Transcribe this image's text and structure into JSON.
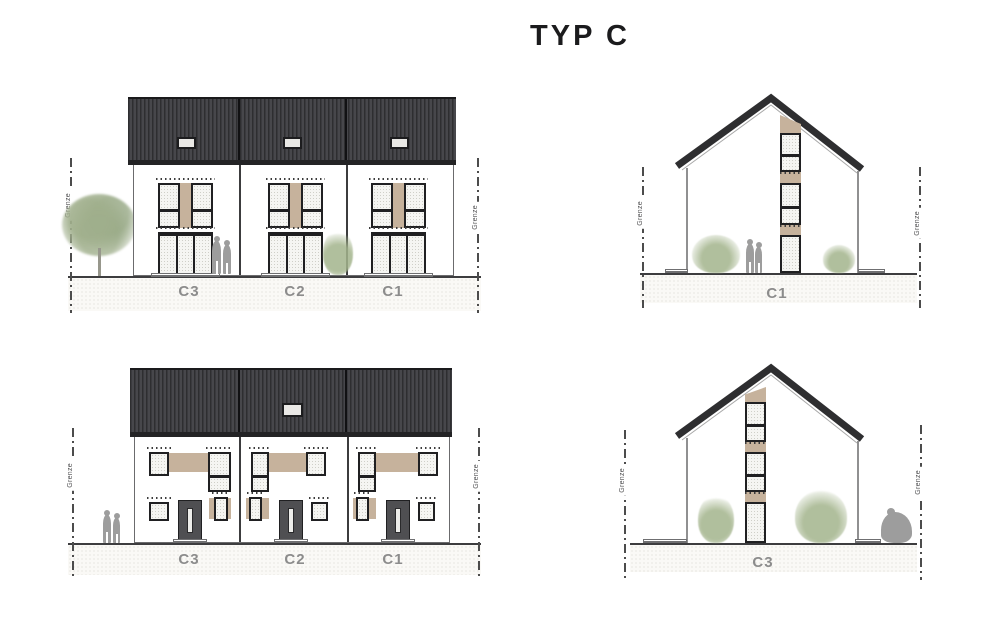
{
  "title": "TYP C",
  "boundary_label": "Grenze",
  "colors": {
    "title_color": "#1b1b1d",
    "roof_dark": "#2e2e30",
    "roof_stripe": "#47474b",
    "frame_dark": "#202022",
    "accent_tan": "#c6b29c",
    "glass_light": "#f5f5f2",
    "ground_fill": "#faf9f6",
    "ground_dot": "#d6d3cc",
    "ground_line": "#3d3d3f",
    "wall_line": "#6b6b6d",
    "label_gray": "#8c8c8c",
    "boundary_gray": "#4c4c4c",
    "vegetation_green": "#a9bb8f",
    "figure_gray": "#9d9d9d"
  },
  "views": {
    "front_elevation": {
      "unit_labels": [
        "C3",
        "C2",
        "C1"
      ]
    },
    "gable_elevation_top": {
      "unit_label": "C1"
    },
    "garden_elevation": {
      "unit_labels": [
        "C3",
        "C2",
        "C1"
      ]
    },
    "gable_elevation_bottom": {
      "unit_label": "C3"
    }
  }
}
